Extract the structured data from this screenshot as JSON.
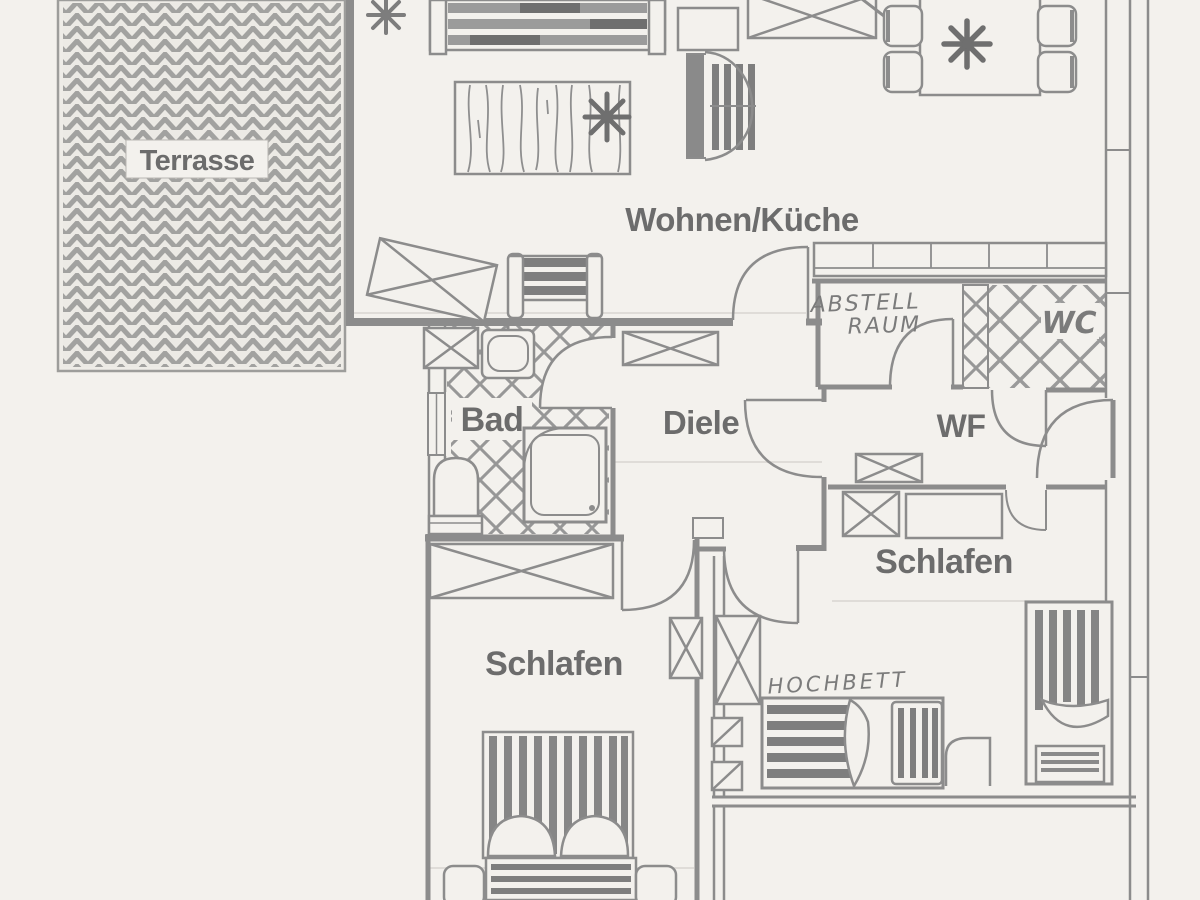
{
  "page": {
    "background_color": "#f3f1ed",
    "wall_ink_color": "#8c8c8c",
    "label_ink_color": "#6c6c6c",
    "handwriting_color": "#7b7b7b"
  },
  "labels": {
    "terrasse": "Terrasse",
    "wohnen_kueche": "Wohnen/Küche",
    "abstellraum_line1": "ABSTELL",
    "abstellraum_line2": "RAUM",
    "wc": "WC",
    "bad": "Bad",
    "diele": "Diele",
    "wf": "WF",
    "schlafen_links": "Schlafen",
    "schlafen_rechts": "Schlafen",
    "hochbett": "HOCHBETT"
  },
  "icons": {
    "plant_icon": "8-ray asterisk star",
    "door_arc": "quarter-circle swing",
    "wardrobe": "crossed rectangle"
  }
}
